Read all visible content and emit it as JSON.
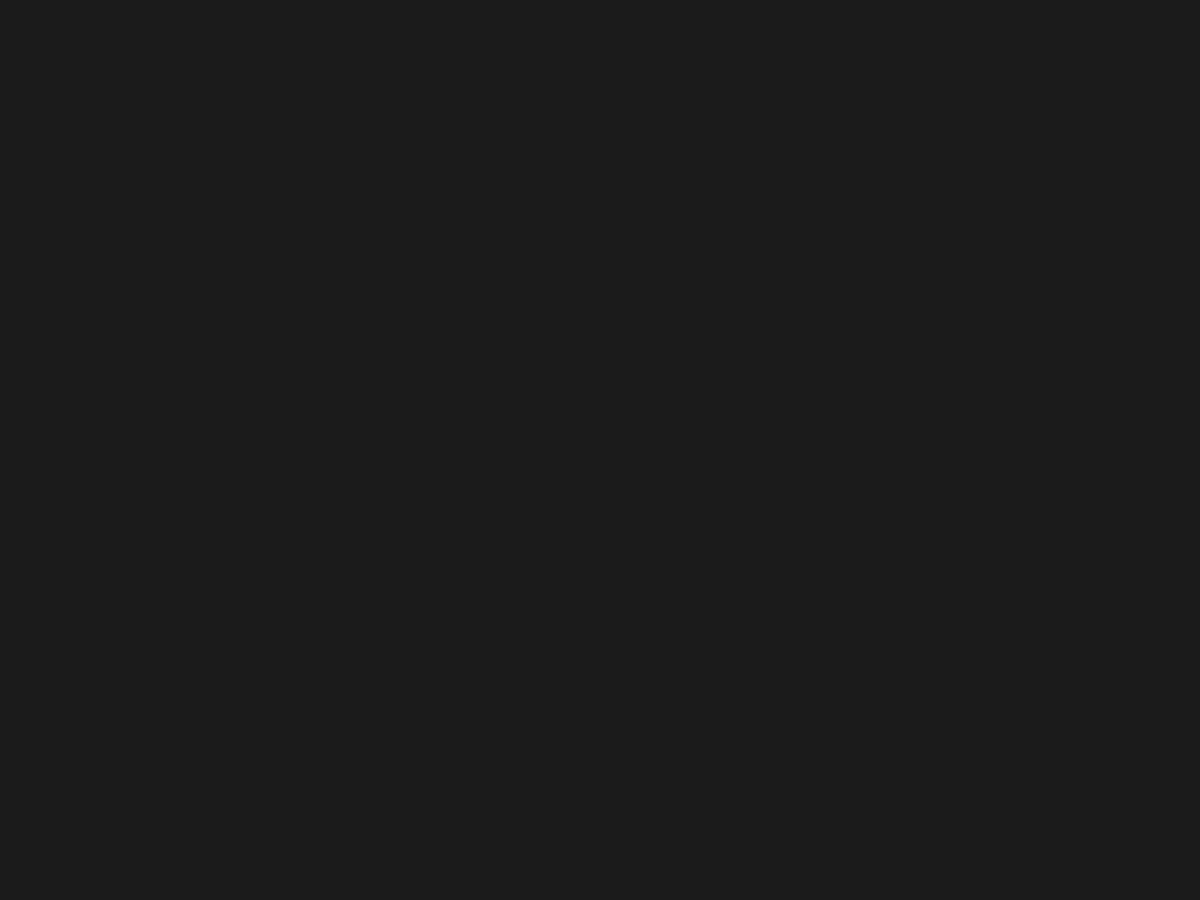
{
  "scene": {
    "w": 1200,
    "h": 900
  },
  "palette": {
    "terr_top": "#b4aaa5",
    "terr_mid": "#a89689",
    "terr_bottom": "#99877a",
    "bld_base": "#cfc5ad",
    "bld_top": "#dcd4c0",
    "bld_edge": "#9c9078",
    "bld_notch": "#b5a98f",
    "dot": "#ded6c3",
    "wall": "#d7ceb7",
    "wall_hi": "#ece5d3",
    "shadow": "#3f3022",
    "pin": "#17191d",
    "pin_glint": "#4c5c6e",
    "seam": "#111111",
    "floor": "#c7cac1",
    "floor_patch": "#e9ebe6",
    "pool": "#ebebe5",
    "panel": "#cdc5ae",
    "glare_core": "#ffffff",
    "glare_mid": "#cfe2f2",
    "glare_outer": "#74a9d4",
    "orange": "#e05617",
    "moss": "#9aa06a"
  },
  "floor": {
    "poly": [
      [
        0,
        0
      ],
      [
        86,
        0
      ],
      [
        52,
        16
      ],
      [
        0,
        38
      ]
    ],
    "patch": [
      [
        0,
        0
      ],
      [
        40,
        0
      ],
      [
        18,
        12
      ],
      [
        0,
        20
      ]
    ],
    "edge": [
      86,
      0,
      0,
      40
    ],
    "moss": [
      4,
      264
    ]
  },
  "terrain": {
    "blotches": [
      [
        1000,
        95,
        270,
        80,
        -6,
        "#b6ada8",
        0.5
      ],
      [
        760,
        110,
        190,
        55,
        -4,
        "#b2a8a2",
        0.38
      ],
      [
        960,
        150,
        30,
        72,
        0,
        "#c0b8b1",
        0.4
      ],
      [
        300,
        115,
        180,
        60,
        -8,
        "#b3a9a3",
        0.32
      ],
      [
        120,
        60,
        140,
        50,
        0,
        "#aba097",
        0.38
      ],
      [
        560,
        330,
        130,
        95,
        0,
        "#b0a096",
        0.22
      ],
      [
        240,
        360,
        130,
        80,
        0,
        "#b2a093",
        0.22
      ],
      [
        600,
        300,
        55,
        65,
        0,
        "#b4aa9e",
        0.25
      ],
      [
        480,
        235,
        60,
        35,
        -20,
        "#bdb3a8",
        0.3
      ],
      [
        160,
        560,
        210,
        120,
        0,
        "#a08c7d",
        0.28
      ],
      [
        180,
        795,
        330,
        130,
        0,
        "#8f7d6c",
        0.38
      ],
      [
        60,
        745,
        70,
        170,
        0,
        "#8c8266",
        0.2
      ],
      [
        650,
        770,
        270,
        120,
        0,
        "#97816e",
        0.28
      ],
      [
        1060,
        790,
        280,
        130,
        0,
        "#9b8b7d",
        0.26
      ],
      [
        660,
        700,
        75,
        30,
        -15,
        "#82695a",
        0.28
      ],
      [
        345,
        357,
        16,
        10,
        0,
        "#87776a",
        0.4
      ],
      [
        420,
        120,
        45,
        20,
        -10,
        "#b9afa8",
        0.4
      ],
      [
        535,
        700,
        90,
        40,
        -5,
        "#8d7866",
        0.22
      ],
      [
        905,
        520,
        200,
        160,
        0,
        "#a4948a",
        0.2
      ],
      [
        175,
        210,
        90,
        60,
        0,
        "#b0a69d",
        0.3
      ]
    ],
    "grain_opacity": 0.14,
    "speck_seed": 9
  },
  "wall": {
    "outer": [
      [
        163,
        207
      ],
      [
        185,
        192
      ],
      [
        210,
        192
      ],
      [
        238,
        199
      ],
      [
        262,
        200
      ],
      [
        282,
        172
      ],
      [
        302,
        170
      ],
      [
        322,
        160
      ],
      [
        338,
        163
      ],
      [
        346,
        156
      ],
      [
        362,
        166
      ],
      [
        400,
        170
      ],
      [
        432,
        186
      ],
      [
        468,
        191
      ],
      [
        508,
        194
      ],
      [
        540,
        191
      ],
      [
        568,
        177
      ],
      [
        592,
        182
      ],
      [
        630,
        180
      ],
      [
        655,
        181
      ],
      [
        700,
        184
      ],
      [
        742,
        187
      ],
      [
        775,
        180
      ],
      [
        800,
        163
      ],
      [
        828,
        167
      ],
      [
        852,
        169
      ],
      [
        876,
        156
      ],
      [
        884,
        154
      ],
      [
        881,
        184
      ],
      [
        906,
        179
      ],
      [
        940,
        173
      ],
      [
        974,
        175
      ],
      [
        1003,
        172
      ],
      [
        1009,
        197
      ],
      [
        1021,
        222
      ],
      [
        1034,
        241
      ],
      [
        1048,
        259
      ],
      [
        1058,
        278
      ],
      [
        1064,
        300
      ],
      [
        1068,
        322
      ],
      [
        1075,
        334
      ],
      [
        1108,
        340
      ],
      [
        1117,
        368
      ],
      [
        1114,
        400
      ],
      [
        1111,
        426
      ],
      [
        1101,
        438
      ],
      [
        1060,
        442
      ],
      [
        1044,
        441
      ],
      [
        1040,
        452
      ],
      [
        1037,
        476
      ],
      [
        1031,
        502
      ],
      [
        1027,
        523
      ],
      [
        1024,
        543
      ],
      [
        1019,
        561
      ],
      [
        1009,
        581
      ],
      [
        996,
        594
      ],
      [
        976,
        613
      ],
      [
        951,
        631
      ],
      [
        917,
        643
      ],
      [
        889,
        651
      ],
      [
        857,
        669
      ],
      [
        829,
        684
      ],
      [
        799,
        696
      ],
      [
        762,
        718
      ],
      [
        739,
        744
      ],
      [
        724,
        750
      ],
      [
        710,
        750
      ],
      [
        695,
        747
      ],
      [
        664,
        742
      ],
      [
        640,
        726
      ],
      [
        621,
        713
      ],
      [
        592,
        691
      ],
      [
        559,
        689
      ],
      [
        529,
        684
      ],
      [
        496,
        667
      ],
      [
        468,
        657
      ],
      [
        443,
        649
      ],
      [
        419,
        643
      ],
      [
        394,
        637
      ],
      [
        362,
        631
      ],
      [
        309,
        629
      ],
      [
        258,
        628
      ],
      [
        228,
        630
      ],
      [
        193,
        634
      ],
      [
        158,
        637
      ],
      [
        119,
        635
      ],
      [
        84,
        632
      ],
      [
        66,
        631
      ],
      [
        48,
        624
      ],
      [
        37,
        600
      ],
      [
        30,
        562
      ],
      [
        28,
        521
      ],
      [
        33,
        504
      ],
      [
        38,
        486
      ],
      [
        49,
        472
      ],
      [
        56,
        454
      ],
      [
        71,
        429
      ],
      [
        83,
        402
      ],
      [
        88,
        376
      ],
      [
        98,
        349
      ],
      [
        113,
        329
      ],
      [
        121,
        309
      ],
      [
        136,
        271
      ],
      [
        149,
        239
      ],
      [
        157,
        221
      ]
    ]
  },
  "panel": {
    "poly": [
      [
        65,
        126
      ],
      [
        213,
        122
      ],
      [
        181,
        200
      ],
      [
        27,
        203
      ]
    ]
  },
  "pool": {
    "poly": [
      [
        459,
        88
      ],
      [
        521,
        85
      ],
      [
        518,
        117
      ],
      [
        454,
        114
      ]
    ],
    "halo": [
      487,
      100,
      52,
      30
    ]
  },
  "rubble": {
    "cx": 538,
    "cy": 200,
    "rx": 36,
    "ry": 13,
    "count": 42,
    "seed": 11
  },
  "citadel": {
    "outer": [
      [
        471,
        261
      ],
      [
        536,
        263
      ],
      [
        546,
        280
      ],
      [
        543,
        321
      ],
      [
        500,
        327
      ],
      [
        476,
        319
      ],
      [
        468,
        288
      ]
    ],
    "towers": [
      [
        471,
        262
      ],
      [
        534,
        263
      ],
      [
        541,
        318
      ],
      [
        477,
        320
      ]
    ],
    "keep": {
      "x": 508,
      "y": 294,
      "w": 28,
      "h": 28,
      "r": -3
    }
  },
  "complex": {
    "poly": [
      [
        236,
        292
      ],
      [
        310,
        288
      ],
      [
        298,
        365
      ],
      [
        230,
        367
      ]
    ],
    "inner": [
      [
        242,
        296
      ],
      [
        305,
        292
      ],
      [
        294,
        361
      ],
      [
        236,
        362
      ]
    ],
    "lines": [
      [
        238,
        308,
        308,
        304
      ],
      [
        256,
        294,
        254,
        364
      ],
      [
        275,
        306,
        273,
        364
      ],
      [
        292,
        305,
        290,
        364
      ],
      [
        238,
        321,
        255,
        319
      ],
      [
        238,
        337,
        254,
        335
      ],
      [
        238,
        352,
        253,
        350
      ]
    ]
  },
  "sanctuary": {
    "x": 1068,
    "y": 394,
    "r": -10,
    "w": 52,
    "h": 58,
    "hlines": [
      -14,
      -2,
      10,
      22
    ],
    "apse_r": 9,
    "well": [
      1097,
      354,
      7.5
    ]
  },
  "halls": [
    [
      756,
      470,
      33,
      46,
      23
    ],
    [
      727,
      534,
      30,
      50,
      21
    ],
    [
      693,
      601,
      31,
      49,
      18
    ],
    [
      466,
      566,
      34,
      52,
      -8
    ]
  ],
  "colonnade": {
    "pts": [
      [
        797,
        467
      ],
      [
        783,
        512
      ],
      [
        768,
        558
      ],
      [
        753,
        602
      ],
      [
        738,
        650
      ],
      [
        724,
        695
      ],
      [
        712,
        730
      ],
      [
        706,
        743
      ]
    ],
    "gap": 10.5
  },
  "grid": {
    "segs": [
      [
        806,
        476,
        872,
        448
      ],
      [
        812,
        498,
        884,
        469
      ],
      [
        820,
        520,
        893,
        490
      ],
      [
        826,
        452,
        843,
        523
      ],
      [
        847,
        443,
        866,
        515
      ],
      [
        868,
        437,
        887,
        508
      ],
      [
        884,
        460,
        900,
        505
      ],
      [
        800,
        512,
        818,
        556
      ]
    ],
    "dot_center": [
      852,
      482
    ],
    "dot_spread": 48,
    "dot_count": 14
  },
  "gate": {
    "x": 607,
    "y": 701,
    "r": -6,
    "w": 30,
    "h": 28
  },
  "cross": {
    "x": 776,
    "y": 594,
    "r": -18
  },
  "shrine": {
    "face": [
      [
        608,
        766
      ],
      [
        630,
        765
      ],
      [
        636,
        798
      ],
      [
        612,
        801
      ]
    ],
    "side": [
      [
        628,
        766
      ],
      [
        634,
        797
      ],
      [
        636,
        798
      ],
      [
        631,
        765
      ]
    ],
    "band": [
      609,
      780,
      22,
      5
    ],
    "shadow": [
      [
        634,
        788
      ],
      [
        672,
        804
      ],
      [
        668,
        813
      ],
      [
        631,
        800
      ]
    ]
  },
  "steles": [
    {
      "face": [
        [
          241,
          198
        ],
        [
          256,
          196
        ],
        [
          260,
          226
        ],
        [
          238,
          228
        ]
      ],
      "side": [
        [
          256,
          196
        ],
        [
          261,
          198
        ],
        [
          264,
          227
        ],
        [
          260,
          226
        ]
      ],
      "shadow": [
        [
          258,
          220
        ],
        [
          300,
          231
        ],
        [
          297,
          238
        ],
        [
          255,
          229
        ]
      ]
    },
    {
      "face": [
        [
          1107,
          153
        ],
        [
          1122,
          151
        ],
        [
          1126,
          188
        ],
        [
          1104,
          190
        ]
      ],
      "side": [
        [
          1122,
          151
        ],
        [
          1127,
          154
        ],
        [
          1130,
          188
        ],
        [
          1126,
          188
        ]
      ],
      "shadow": [
        [
          1124,
          172
        ],
        [
          1181,
          185
        ],
        [
          1177,
          193
        ],
        [
          1121,
          187
        ]
      ]
    }
  ],
  "buildings": [
    [
      196,
      270,
      22,
      13,
      -10,
      ""
    ],
    [
      291,
      233,
      20,
      12,
      -15,
      ""
    ],
    [
      131,
      419,
      26,
      17,
      -28,
      "l"
    ],
    [
      432,
      192,
      24,
      13,
      -12,
      "c"
    ],
    [
      427,
      251,
      20,
      12,
      -18,
      ""
    ],
    [
      392,
      331,
      24,
      14,
      -15,
      ""
    ],
    [
      337,
      347,
      20,
      12,
      -10,
      ""
    ],
    [
      553,
      249,
      20,
      13,
      -6,
      ""
    ],
    [
      607,
      233,
      16,
      24,
      -4,
      "l"
    ],
    [
      609,
      281,
      24,
      16,
      -22,
      ""
    ],
    [
      689,
      253,
      26,
      13,
      -8,
      "c"
    ],
    [
      724,
      283,
      24,
      14,
      -12,
      "c"
    ],
    [
      777,
      301,
      24,
      14,
      -5,
      ""
    ],
    [
      866,
      303,
      26,
      14,
      -3,
      "c"
    ],
    [
      686,
      348,
      18,
      22,
      -3,
      "l"
    ],
    [
      742,
      333,
      13,
      24,
      -2,
      ""
    ],
    [
      912,
      347,
      24,
      16,
      -10,
      "l"
    ],
    [
      995,
      314,
      18,
      12,
      -8,
      ""
    ],
    [
      777,
      377,
      26,
      14,
      -6,
      "c"
    ],
    [
      829,
      211,
      22,
      13,
      -8,
      ""
    ],
    [
      941,
      234,
      20,
      12,
      -6,
      ""
    ],
    [
      905,
      455,
      20,
      16,
      -5,
      "l"
    ],
    [
      971,
      486,
      22,
      15,
      -30,
      ""
    ],
    [
      967,
      544,
      28,
      17,
      -5,
      "c"
    ],
    [
      852,
      612,
      24,
      15,
      -12,
      ""
    ],
    [
      867,
      573,
      24,
      16,
      -10,
      "c"
    ],
    [
      449,
      424,
      26,
      30,
      -8,
      "c"
    ],
    [
      287,
      423,
      22,
      13,
      -15,
      ""
    ],
    [
      299,
      466,
      20,
      16,
      -15,
      "l"
    ],
    [
      356,
      518,
      24,
      14,
      -15,
      ""
    ],
    [
      452,
      502,
      26,
      16,
      -20,
      ""
    ],
    [
      551,
      548,
      26,
      16,
      -15,
      ""
    ],
    [
      526,
      601,
      24,
      14,
      -15,
      ""
    ],
    [
      597,
      607,
      26,
      16,
      -20,
      "c"
    ],
    [
      553,
      351,
      24,
      16,
      -10,
      "c"
    ],
    [
      490,
      370,
      26,
      13,
      -8,
      ""
    ],
    [
      625,
      534,
      18,
      12,
      -12,
      ""
    ],
    [
      560,
      428,
      18,
      11,
      -10,
      ""
    ]
  ],
  "pins": [
    [
      207,
      100,
      7,
      19
    ],
    [
      243,
      216,
      4,
      13
    ],
    [
      284,
      266,
      3,
      21
    ],
    [
      108,
      423,
      11,
      23
    ],
    [
      437,
      385,
      3,
      16
    ],
    [
      747,
      434,
      2,
      17
    ],
    [
      832,
      434,
      3,
      17
    ],
    [
      800,
      558,
      3,
      17
    ],
    [
      683,
      624,
      3,
      18
    ],
    [
      152,
      644,
      3,
      15
    ],
    [
      1096,
      156,
      -4,
      18
    ],
    [
      1088,
      313,
      -4,
      18
    ],
    [
      1107,
      350,
      -4,
      17
    ],
    [
      1042,
      394,
      -4,
      15
    ]
  ],
  "sticks": [
    [
      581,
      675,
      584,
      695
    ],
    [
      722,
      678,
      725,
      704
    ],
    [
      694,
      757,
      697,
      781
    ],
    [
      612,
      799,
      614,
      817
    ],
    [
      692,
      527,
      694,
      541
    ],
    [
      430,
      585,
      432,
      600
    ]
  ],
  "glare": {
    "cx": 52,
    "cy": 622,
    "r": 100,
    "core": [
      40,
      616,
      40,
      44
    ],
    "mid": [
      46,
      620,
      62,
      58
    ],
    "blobs": [
      [
        92,
        576,
        13,
        9
      ],
      [
        20,
        682,
        16,
        11
      ],
      [
        97,
        660,
        9,
        7
      ],
      [
        70,
        598,
        10,
        8
      ]
    ],
    "tail": [
      20,
      700,
      40,
      26
    ],
    "streak": [
      0,
      562,
      42,
      548
    ],
    "seed": 5
  },
  "glints": [
    [
      33,
      713
    ],
    [
      44,
      757
    ],
    [
      79,
      792
    ],
    [
      112,
      789
    ],
    [
      232,
      851
    ],
    [
      103,
      744
    ]
  ],
  "orange": {
    "poly": [
      [
        70,
        612
      ],
      [
        87,
        621
      ],
      [
        85,
        658
      ],
      [
        71,
        650
      ]
    ]
  },
  "seam": {
    "x_top": 654,
    "x_mid": 655,
    "x_bottom": 660
  },
  "vignette_opacity": 0.2
}
